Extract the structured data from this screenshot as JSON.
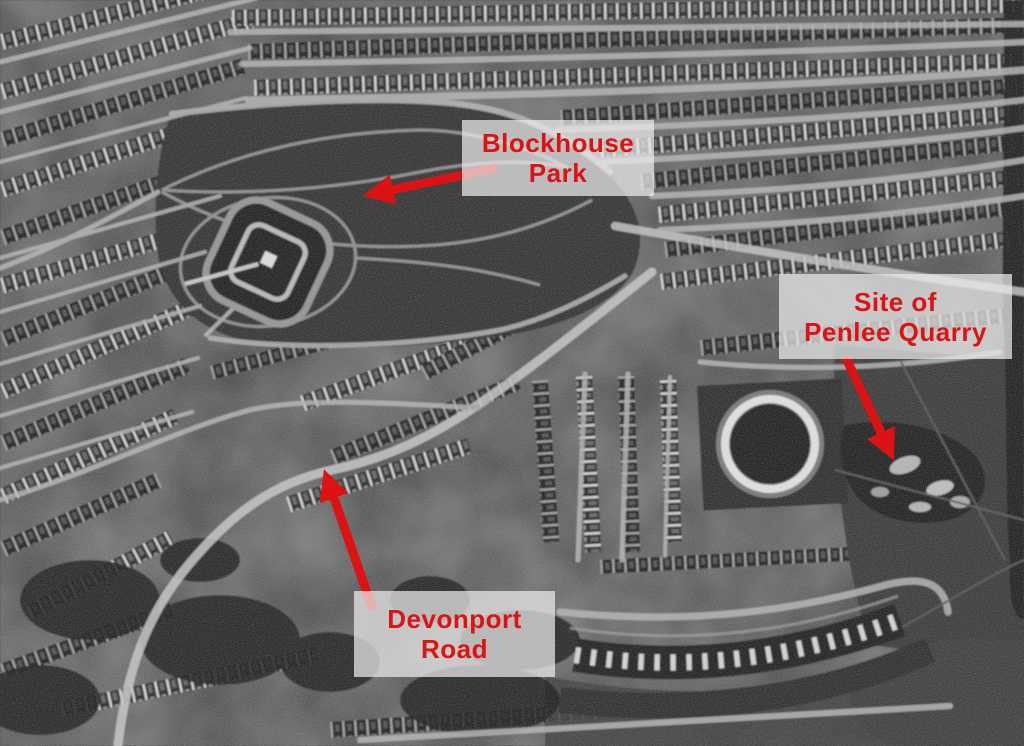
{
  "colors": {
    "annotation_red": "#dd1212",
    "label_background": "rgba(236,236,236,0.72)",
    "photo_dark": "#111111",
    "photo_light": "#d6d6d6"
  },
  "annotations": {
    "blockhouse_park": {
      "line1": "Blockhouse",
      "line2": "Park"
    },
    "penlee_quarry": {
      "line1": "Site of",
      "line2": "Penlee Quarry"
    },
    "devonport_road": {
      "line1": "Devonport",
      "line2": "Road"
    }
  }
}
